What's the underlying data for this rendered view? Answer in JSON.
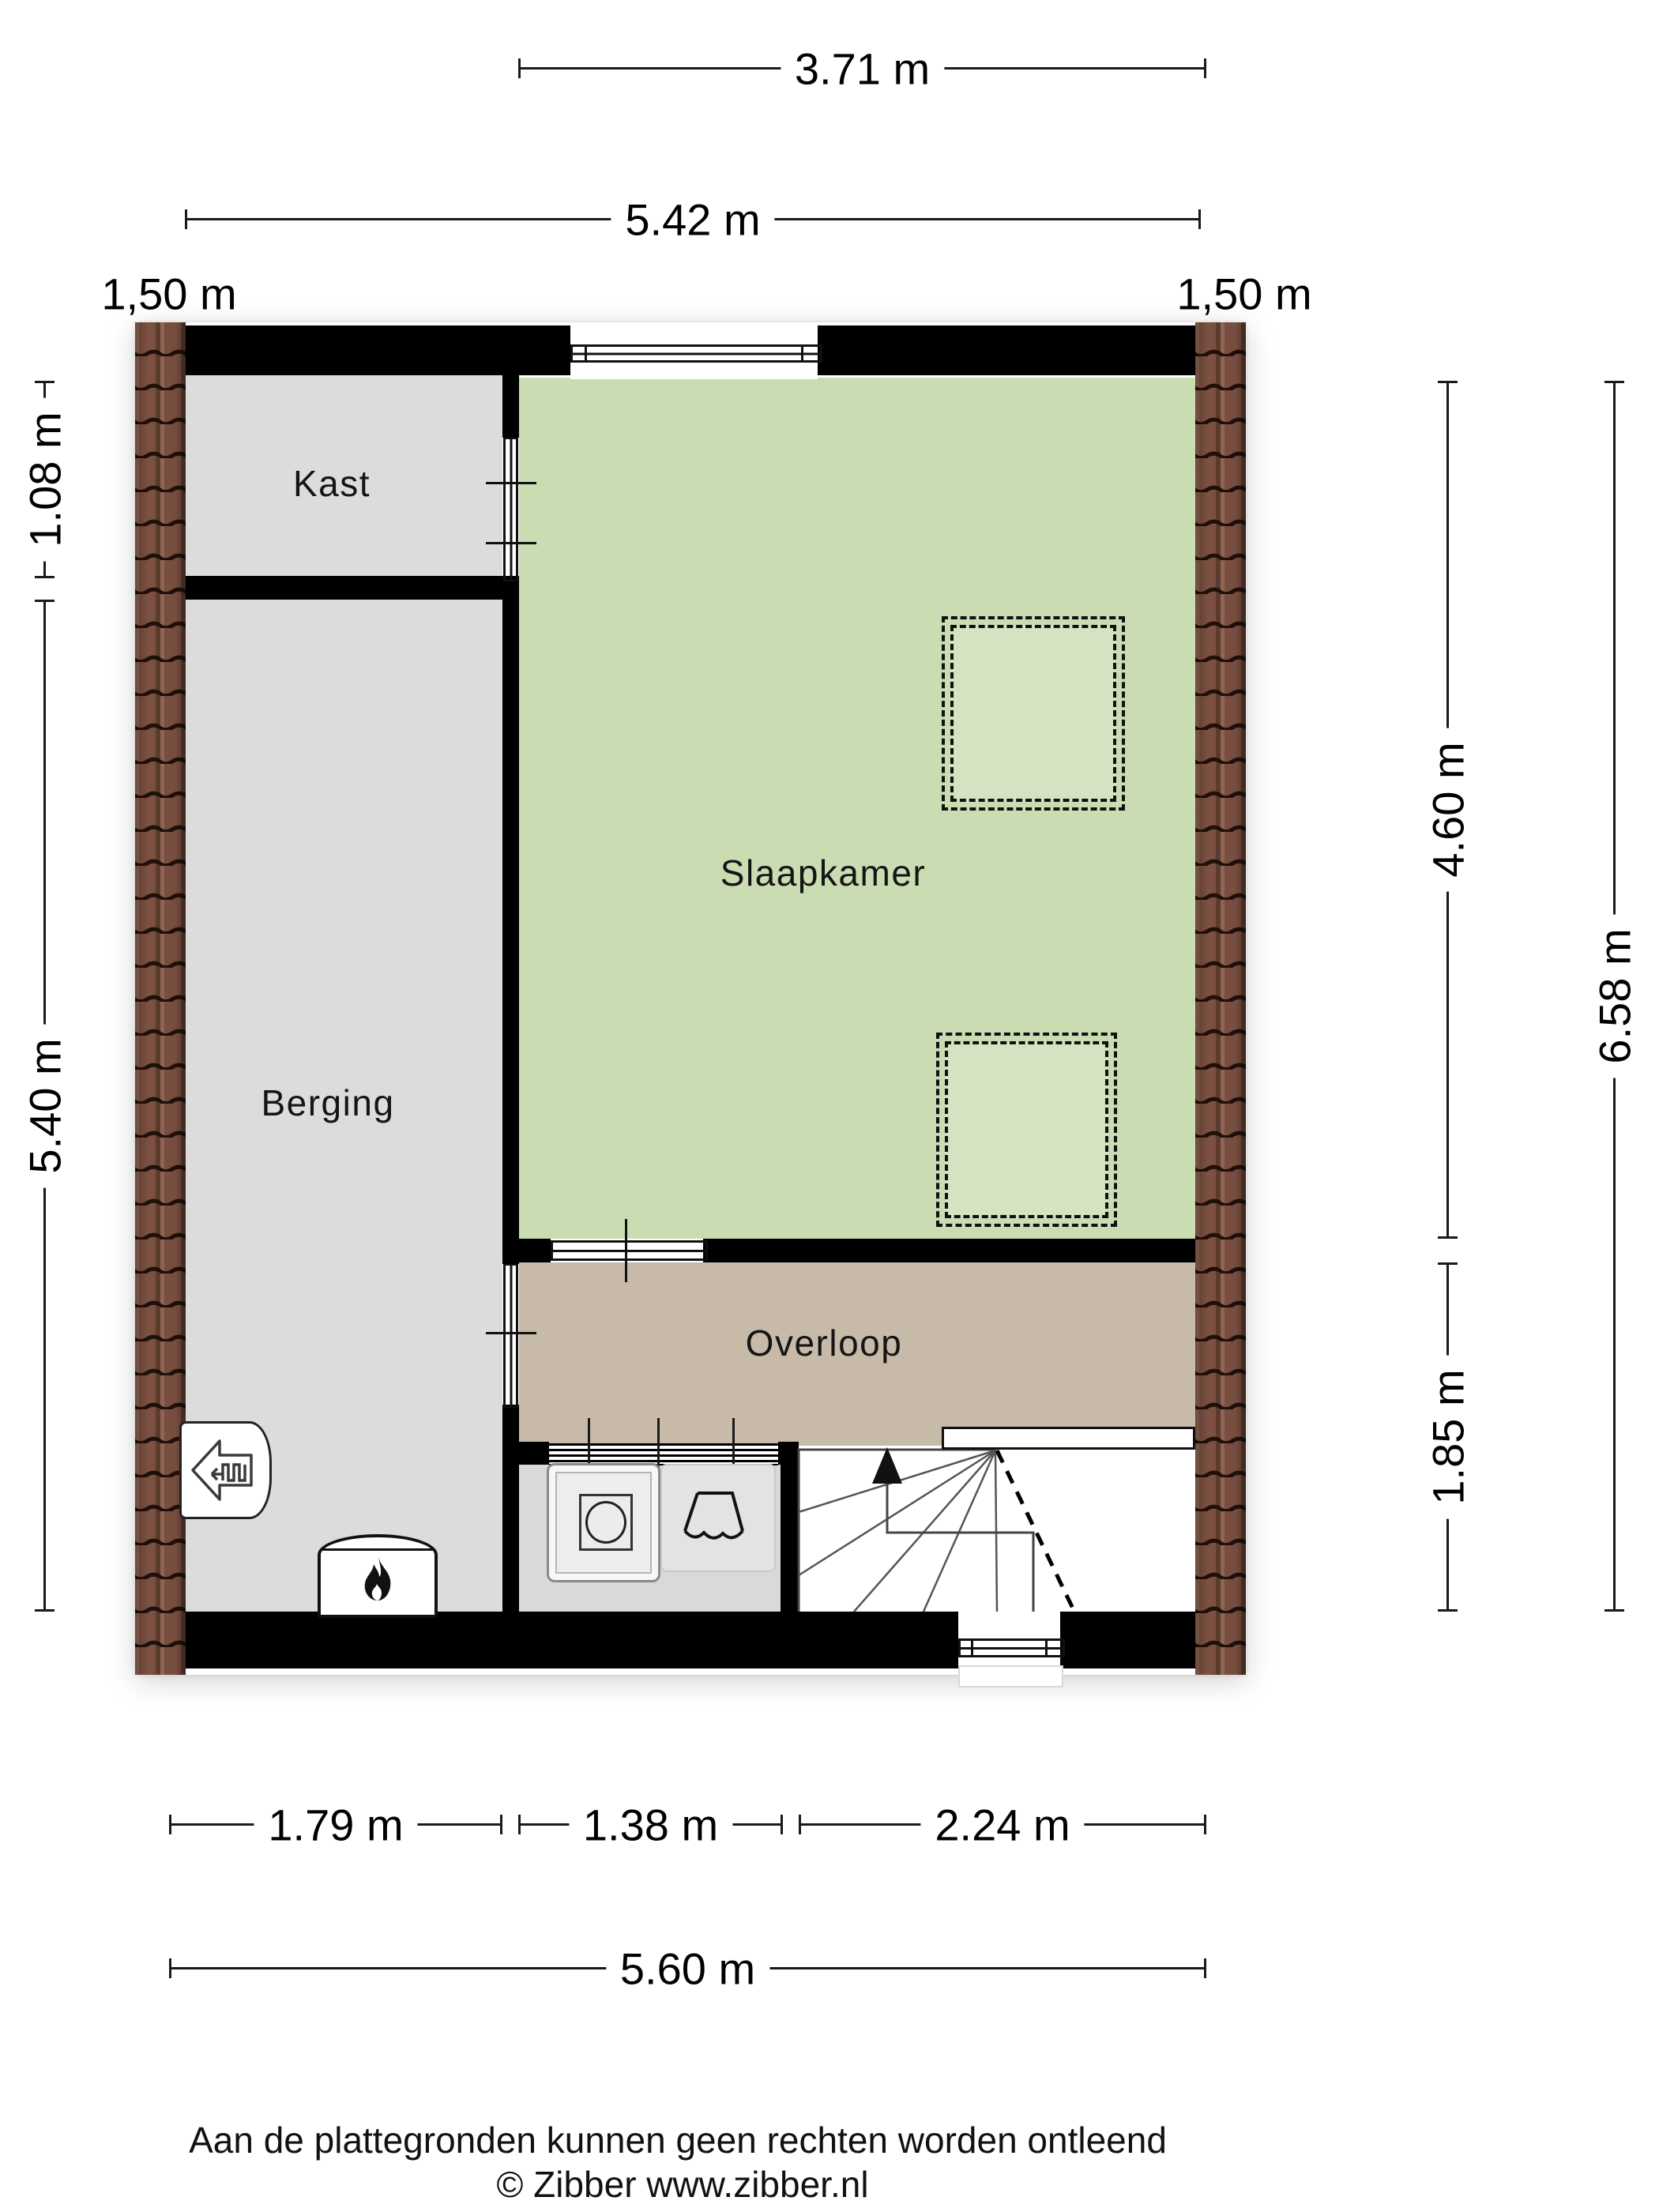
{
  "rooms": {
    "kast": {
      "label": "Kast"
    },
    "berging": {
      "label": "Berging"
    },
    "slaapkamer": {
      "label": "Slaapkamer"
    },
    "overloop": {
      "label": "Overloop"
    }
  },
  "dimensions": {
    "top_width_inner": {
      "label": "3.71 m"
    },
    "top_width_outer": {
      "label": "5.42 m"
    },
    "roof_left": {
      "label": "1,50 m"
    },
    "roof_right": {
      "label": "1,50 m"
    },
    "left_kast_depth": {
      "label": "1.08 m"
    },
    "left_berging_depth": {
      "label": "5.40 m"
    },
    "right_slaapkamer_depth": {
      "label": "4.60 m"
    },
    "right_overloop_depth": {
      "label": "1.85 m"
    },
    "right_total_depth": {
      "label": "6.58 m"
    },
    "bottom_berging_width": {
      "label": "1.79 m"
    },
    "bottom_laundry_width": {
      "label": "1.38 m"
    },
    "bottom_stairs_width": {
      "label": "2.24 m"
    },
    "bottom_total_width": {
      "label": "5.60 m"
    }
  },
  "footer": {
    "disclaimer": "Aan de plattegronden kunnen geen rechten worden ontleend",
    "credit": "© Zibber www.zibber.nl"
  },
  "colors": {
    "slaapkamer_fill": "#cadcb2",
    "overloop_fill": "#c7baa9",
    "kast_berging_fill": "#dcdcdc",
    "laundry_fill": "#d9d9d9",
    "wall": "#000000",
    "roof_tile_base": "#7c5142",
    "roof_tile_dark": "#20100b",
    "dimension_text": "#000000"
  }
}
